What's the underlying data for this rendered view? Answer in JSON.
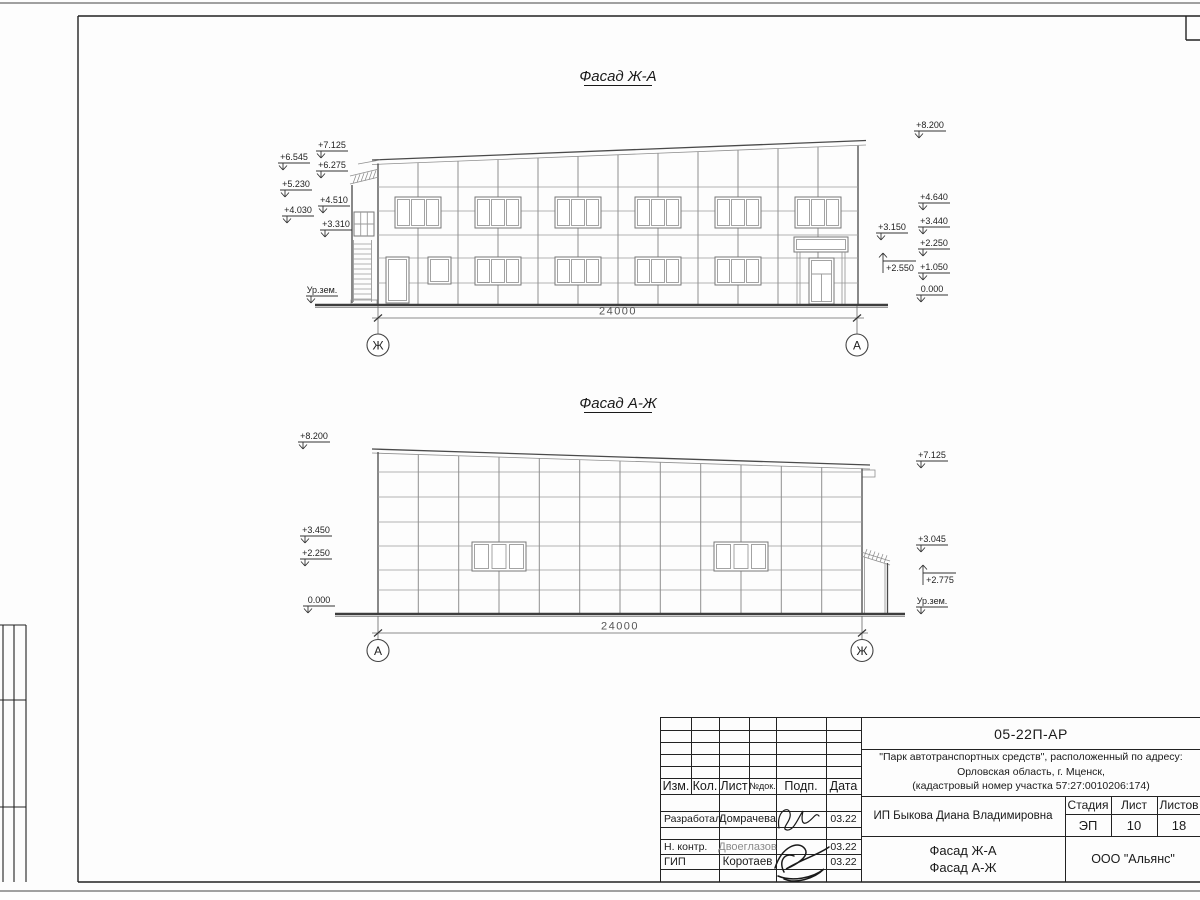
{
  "drawing": {
    "facade1": {
      "title": "Фасад Ж-А",
      "dimension": "24000",
      "axis_left": "Ж",
      "axis_right": "А",
      "marks_left": [
        "+7.125",
        "+6.545",
        "+6.275",
        "+5.230",
        "+4.510",
        "+4.030",
        "+3.310",
        "Ур.зем."
      ],
      "marks_right": [
        "+8.200",
        "+4.640",
        "+3.440",
        "+2.250",
        "+1.050",
        "0.000",
        "+3.150",
        "+2.550"
      ]
    },
    "facade2": {
      "title": "Фасад А-Ж",
      "dimension": "24000",
      "axis_left": "А",
      "axis_right": "Ж",
      "marks_left": [
        "+8.200",
        "+3.450",
        "+2.250",
        "0.000"
      ],
      "marks_right": [
        "+7.125",
        "+3.045",
        "+2.775",
        "Ур.зем."
      ]
    }
  },
  "title_block": {
    "doc_number": "05-22П-АР",
    "project_line1": "\"Парк автотранспортных средств\",  расположенный по адресу:",
    "project_line2": "Орловская область, г. Мценск,",
    "project_line3": "(кадастровый номер участка 57:27:0010206:174)",
    "client": "ИП Быкова Диана Владимировна",
    "sheet_title_line1": "Фасад Ж-А",
    "sheet_title_line2": "Фасад А-Ж",
    "organization": "ООО \"Альянс\"",
    "stage_label": "Стадия",
    "sheet_label": "Лист",
    "sheets_label": "Листов",
    "stage": "ЭП",
    "sheet_no": "10",
    "sheets_total": "18",
    "col_izm": "Изм.",
    "col_kol": "Кол.",
    "col_list": "Лист",
    "col_doc": "№док.",
    "col_podp": "Подп.",
    "col_data": "Дата",
    "role1": "Разработал",
    "name1": "Домрачева",
    "date1": "03.22",
    "role2": "Н. контр.",
    "name2": "Двоеглазов",
    "date2": "03.22",
    "role3": "ГИП",
    "name3": "Коротаев",
    "date3": "03.22"
  }
}
